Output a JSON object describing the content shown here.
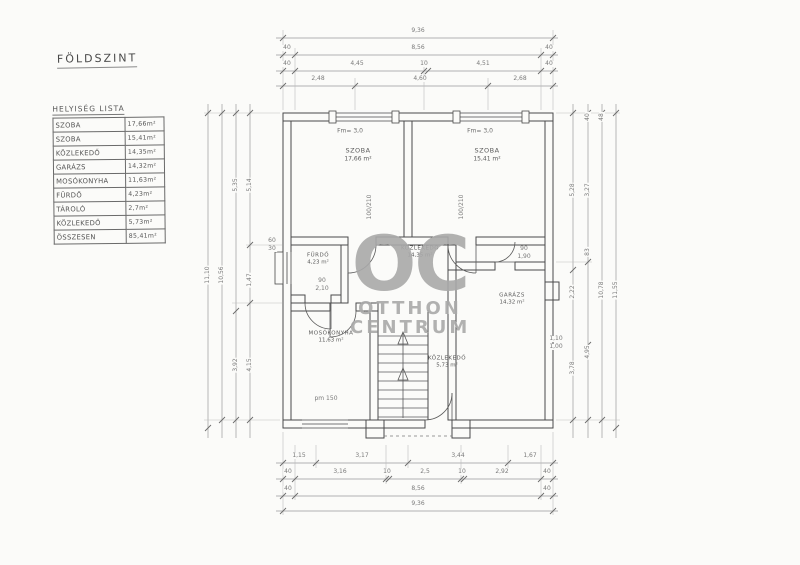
{
  "page": {
    "title": "FÖLDSZINT"
  },
  "watermark": {
    "logo": "OC",
    "line1": "OTTHON",
    "line2": "CENTRUM"
  },
  "room_list": {
    "header": "HELYISÉG LISTA",
    "rows": [
      {
        "name": "SZOBA",
        "area": "17,66m²"
      },
      {
        "name": "SZOBA",
        "area": "15,41m²"
      },
      {
        "name": "KÖZLEKEDŐ",
        "area": "14,35m²"
      },
      {
        "name": "GARÁZS",
        "area": "14,32m²"
      },
      {
        "name": "MOSÓKONYHA",
        "area": "11,63m²"
      },
      {
        "name": "FÜRDŐ",
        "area": "4,23m²"
      },
      {
        "name": "TÁROLÓ",
        "area": "2,7m²"
      },
      {
        "name": "KÖZLEKEDŐ",
        "area": "5,73m²"
      },
      {
        "name": "ÖSSZESEN",
        "area": "85,41m²"
      }
    ]
  },
  "rooms": {
    "szoba1": {
      "name": "SZOBA",
      "area": "17,66 m²",
      "height": "Fm= 3,0"
    },
    "szoba2": {
      "name": "SZOBA",
      "area": "15,41 m²",
      "height": "Fm= 3,0"
    },
    "furdo": {
      "name": "FÜRDŐ",
      "area": "4,23 m²"
    },
    "kozlekedo": {
      "name": "KÖZLEKEDŐ",
      "area": "14,35 m²"
    },
    "mosokonyha": {
      "name": "MOSÓKONYHA",
      "area": "11,63 m²"
    },
    "kozlekedo2": {
      "name": "KÖZLEKEDŐ",
      "area": "5,73 m²"
    },
    "garazs": {
      "name": "GARÁZS",
      "area": "14,32 m²"
    }
  },
  "dimensions": [
    {
      "t": "9,36",
      "x": 418,
      "y": 31
    },
    {
      "t": "40",
      "x": 287,
      "y": 48
    },
    {
      "t": "8,56",
      "x": 418,
      "y": 48
    },
    {
      "t": "40",
      "x": 549,
      "y": 48
    },
    {
      "t": "40",
      "x": 287,
      "y": 64
    },
    {
      "t": "4,45",
      "x": 357,
      "y": 64
    },
    {
      "t": "10",
      "x": 424,
      "y": 64
    },
    {
      "t": "4,51",
      "x": 483,
      "y": 64
    },
    {
      "t": "40",
      "x": 549,
      "y": 64
    },
    {
      "t": "2,48",
      "x": 318,
      "y": 79
    },
    {
      "t": "4,60",
      "x": 420,
      "y": 79
    },
    {
      "t": "2,68",
      "x": 520,
      "y": 79
    },
    {
      "t": "1,15",
      "x": 299,
      "y": 456
    },
    {
      "t": "3,17",
      "x": 362,
      "y": 456
    },
    {
      "t": "3,44",
      "x": 458,
      "y": 456
    },
    {
      "t": "1,67",
      "x": 530,
      "y": 456
    },
    {
      "t": "40",
      "x": 288,
      "y": 472
    },
    {
      "t": "3,16",
      "x": 340,
      "y": 472
    },
    {
      "t": "10",
      "x": 387,
      "y": 472
    },
    {
      "t": "2,5",
      "x": 425,
      "y": 472
    },
    {
      "t": "10",
      "x": 462,
      "y": 472
    },
    {
      "t": "2,92",
      "x": 502,
      "y": 472
    },
    {
      "t": "40",
      "x": 547,
      "y": 472
    },
    {
      "t": "40",
      "x": 288,
      "y": 489
    },
    {
      "t": "8,56",
      "x": 418,
      "y": 489
    },
    {
      "t": "40",
      "x": 547,
      "y": 489
    },
    {
      "t": "9,36",
      "x": 418,
      "y": 504
    },
    {
      "t": "11,10",
      "x": 208,
      "y": 275,
      "r": -90
    },
    {
      "t": "10,56",
      "x": 222,
      "y": 275,
      "r": -90
    },
    {
      "t": "5,35",
      "x": 236,
      "y": 185,
      "r": -90
    },
    {
      "t": "3,92",
      "x": 236,
      "y": 365,
      "r": -90
    },
    {
      "t": "5,14",
      "x": 250,
      "y": 185,
      "r": -90
    },
    {
      "t": "1,47",
      "x": 250,
      "y": 280,
      "r": -90
    },
    {
      "t": "4,15",
      "x": 250,
      "y": 365,
      "r": -90
    },
    {
      "t": "60",
      "x": 272,
      "y": 241
    },
    {
      "t": "30",
      "x": 272,
      "y": 249
    },
    {
      "t": "5,28",
      "x": 573,
      "y": 190,
      "r": -90
    },
    {
      "t": "2,22",
      "x": 573,
      "y": 292,
      "r": -90
    },
    {
      "t": "3,78",
      "x": 573,
      "y": 368,
      "r": -90
    },
    {
      "t": "40",
      "x": 588,
      "y": 117,
      "r": -90
    },
    {
      "t": "3,27",
      "x": 588,
      "y": 190,
      "r": -90
    },
    {
      "t": "83",
      "x": 588,
      "y": 252,
      "r": -90
    },
    {
      "t": "4,95",
      "x": 588,
      "y": 352,
      "r": -90
    },
    {
      "t": "48",
      "x": 602,
      "y": 117,
      "r": -90
    },
    {
      "t": "10,78",
      "x": 602,
      "y": 290,
      "r": -90
    },
    {
      "t": "11,55",
      "x": 616,
      "y": 290,
      "r": -90
    },
    {
      "t": "100/210",
      "x": 370,
      "y": 207,
      "r": -90
    },
    {
      "t": "100/210",
      "x": 462,
      "y": 207,
      "r": -90
    },
    {
      "t": "90",
      "x": 322,
      "y": 281
    },
    {
      "t": "2,10",
      "x": 322,
      "y": 289
    },
    {
      "t": "90",
      "x": 524,
      "y": 249
    },
    {
      "t": "1,90",
      "x": 524,
      "y": 257
    },
    {
      "t": "1,10",
      "x": 556,
      "y": 339
    },
    {
      "t": "1,00",
      "x": 556,
      "y": 347
    },
    {
      "t": "pm 150",
      "x": 326,
      "y": 399
    }
  ]
}
